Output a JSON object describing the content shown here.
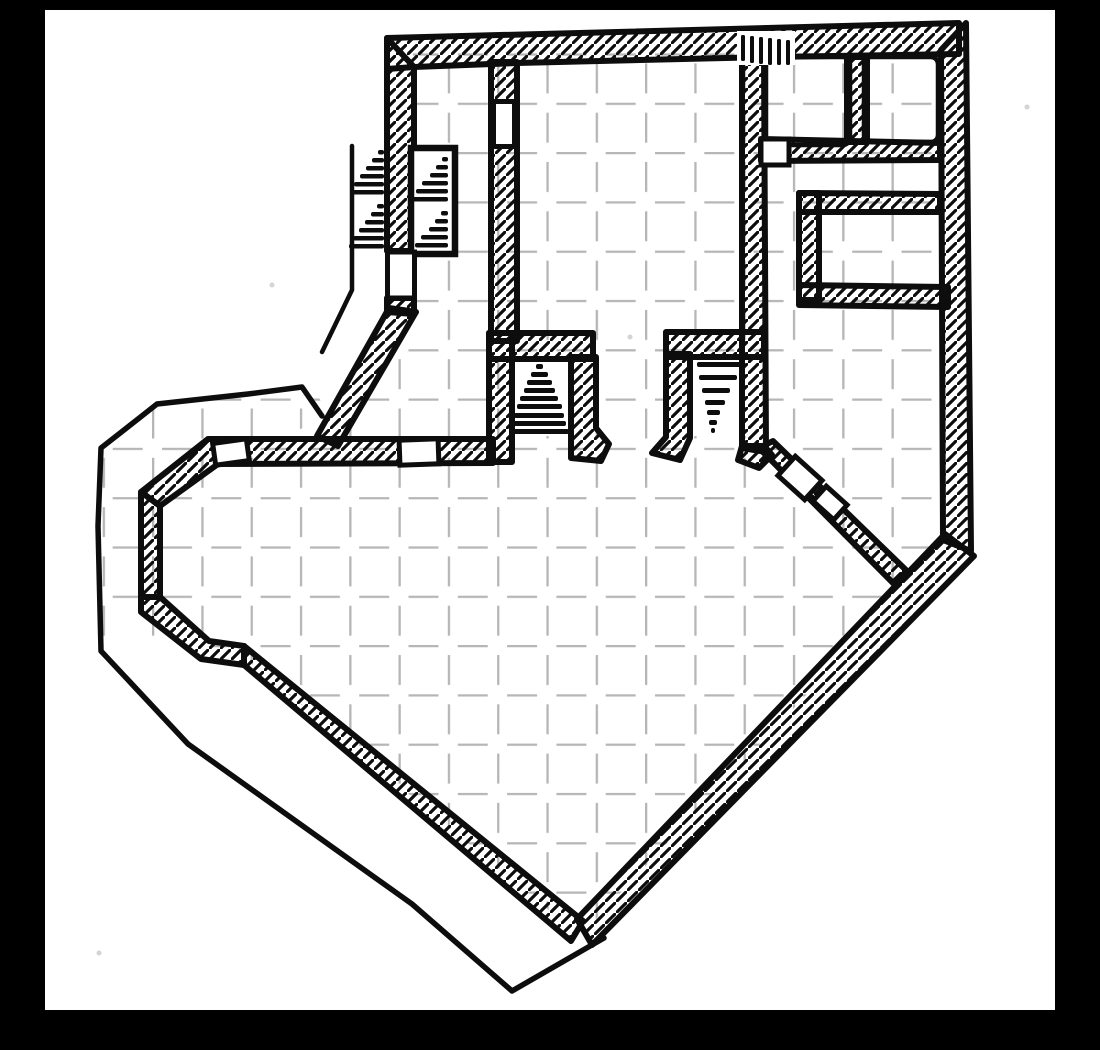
{
  "map": {
    "kind": "hand-drawn dungeon floor plan, ink on graph paper, photographed inside a black frame",
    "style": {
      "frame": "#000000",
      "paper": "#ffffff",
      "ink": "#0d0d0d",
      "grid": "#b6b6b6",
      "speck": "#d4d4d4",
      "wall_stroke": 6,
      "outline_stroke": 5.5,
      "thin_stroke": 4.5,
      "door_stroke": 5,
      "grid_stroke": 4.6,
      "hatch_stroke": 3.2
    },
    "paper_rect": {
      "x": 45,
      "y": 10,
      "w": 1010,
      "h": 1000
    },
    "grid": {
      "origin_x": 53.4,
      "origin_y": 53.4,
      "cell": 49.3,
      "dash_from": 10,
      "dash_to": 40
    },
    "floors": [
      "M493,50 L767,50 L767,352 L493,352 Z",
      "M413,50 L501,50 L501,458 L330,458 L416,310 L413,306 Z",
      "M205,436 L765,436 L765,294 L944,294 L944,548 L580,936 L240,654 L208,648 L136,600 L136,494 Z",
      "M586,338 L667,338 L667,462 L586,462 Z",
      "M759,146 L947,146 L947,204 L807,204 L807,350 L759,350 Z",
      "M761,53 L854,53 L854,150 L761,150 Z",
      "M861,53 L942,53 L942,150 L861,150 Z",
      "M816,206 L950,206 L950,294 L816,294 Z",
      "M158,402 L240,392 L314,386 L328,418 L220,461 L164,505 L164,597 L205,638 L100,638 L100,452 Z"
    ],
    "walls": [
      {
        "name": "wall-north-band",
        "d": "M387,38 L959,23 L959,54 L768,57 L517,63 L414,67 L387,69 Z"
      },
      {
        "name": "wall-west-upper",
        "d": "M387,38 L414,67 L414,251 L387,251 Z"
      },
      {
        "name": "wall-west-stub",
        "d": "M387,298 L414,298 L414,314 L387,312 Z"
      },
      {
        "name": "wall-nw-diagonal",
        "d": "M389,308 L416,312 L338,446 L317,436 Z"
      },
      {
        "name": "wall-hall-west",
        "d": "M491,62 L517,62 L517,341 L491,341 Z"
      },
      {
        "name": "wall-hall-east",
        "d": "M742,55 L764,55 L766,452 L742,448 Z"
      },
      {
        "name": "wall-cavern-north",
        "d": "M208,439 L493,439 L493,463 L218,464 L160,506 L141,492 Z"
      },
      {
        "name": "wall-west-vertical",
        "d": "M141,492 L160,506 L160,597 L141,597 Z"
      },
      {
        "name": "wall-west-bend",
        "d": "M141,597 L160,597 L209,641 L244,646 L244,665 L201,659 L141,612 Z"
      },
      {
        "name": "wall-southwest-diagonal",
        "d": "M244,646 L583,921 L571,941 L244,665 Z"
      },
      {
        "name": "wall-southeast-band",
        "d": "M577,919 L945,534 L974,556 L592,945 Z"
      },
      {
        "name": "wall-east",
        "d": "M941,50 L966,23 L971,551 L943,540 Z"
      },
      {
        "name": "wall-se-inner-diagonal",
        "d": "M759,448 L773,441 L907,571 L895,585 Z"
      },
      {
        "name": "wall-alcove-west-top",
        "d": "M489,333 L593,333 L593,359 L489,359 Z"
      },
      {
        "name": "wall-alcove-west-left",
        "d": "M489,333 L512,333 L512,462 L489,462 Z"
      },
      {
        "name": "wall-alcove-west-right",
        "d": "M571,357 L596,357 L596,428 L609,444 L601,461 L571,458 Z"
      },
      {
        "name": "wall-alcove-east-top",
        "d": "M666,332 L764,332 L764,357 L666,357 Z"
      },
      {
        "name": "wall-alcove-east-left",
        "d": "M666,354 L690,354 L690,438 L680,460 L652,453 L666,437 Z"
      },
      {
        "name": "wall-alcove-east-foot",
        "d": "M742,446 L764,446 L772,455 L759,468 L738,460 Z"
      },
      {
        "name": "wall-ne-rooms-divider",
        "d": "M847,57 L867,57 L867,142 L847,142 Z"
      },
      {
        "name": "wall-ne-rooms-south",
        "d": "M761,139 L940,143 L940,160 L761,161 Z"
      },
      {
        "name": "wall-inner-room-top",
        "d": "M799,193 L940,194 L940,212 L799,212 Z"
      },
      {
        "name": "wall-inner-room-left",
        "d": "M799,193 L819,193 L819,300 L799,300 Z"
      },
      {
        "name": "wall-inner-room-bottom",
        "d": "M799,285 L948,287 L948,307 L799,305 Z"
      }
    ],
    "outlines": [
      {
        "name": "outline-outer-boundary",
        "width": 5.5,
        "d": "M322,416 L302,387 L248,394 L157,404 L138,419 L101,448 L98,526 L101,651 L188,744 L412,904 L512,991 L604,938"
      },
      {
        "name": "outline-west-stair-wall",
        "width": 4.5,
        "d": "M352,146 L352,290 L322,352"
      }
    ],
    "room_borders": [
      {
        "name": "room-ne-1-border",
        "x": 766,
        "y": 57,
        "w": 84,
        "h": 88,
        "r": 7
      },
      {
        "name": "room-ne-2-border",
        "x": 864,
        "y": 57,
        "w": 74,
        "h": 85,
        "r": 7
      }
    ],
    "stair_box": {
      "name": "stair-box",
      "x": 411,
      "y": 148,
      "w": 44,
      "h": 106
    },
    "doors": [
      {
        "name": "door-corridor-to-hall",
        "cx": 504,
        "cy": 124,
        "w": 21,
        "h": 45,
        "angle": 0
      },
      {
        "name": "door-west-wall",
        "cx": 401,
        "cy": 275,
        "w": 27,
        "h": 46,
        "angle": 0
      },
      {
        "name": "door-junction-south-wall",
        "cx": 419,
        "cy": 452,
        "w": 39,
        "h": 25,
        "angle": -2
      },
      {
        "name": "door-corridor-west-end",
        "cx": 231,
        "cy": 452,
        "w": 34,
        "h": 22,
        "angle": -8
      },
      {
        "name": "door-se-diagonal-1",
        "cx": 800,
        "cy": 478,
        "w": 36,
        "h": 26,
        "angle": 42
      },
      {
        "name": "door-se-diagonal-2",
        "cx": 830,
        "cy": 503,
        "w": 28,
        "h": 20,
        "angle": 42
      },
      {
        "name": "door-ne-room1-south",
        "cx": 775,
        "cy": 152,
        "w": 28,
        "h": 26,
        "angle": 0
      }
    ],
    "stairs": [
      {
        "name": "stairs-alcove-west",
        "bar_h": 5,
        "bars": [
          [
            536,
            364,
            7
          ],
          [
            531,
            372,
            17
          ],
          [
            527,
            380,
            25
          ],
          [
            524,
            388,
            31
          ],
          [
            520,
            396,
            38
          ],
          [
            517,
            404,
            45
          ],
          [
            514,
            413,
            50
          ],
          [
            511,
            421,
            55
          ],
          [
            509,
            429,
            60
          ]
        ]
      },
      {
        "name": "stairs-alcove-east",
        "bar_h": 5,
        "bars": [
          [
            697,
            362,
            46
          ],
          [
            699,
            375,
            38
          ],
          [
            702,
            388,
            28
          ],
          [
            705,
            400,
            20
          ],
          [
            707,
            410,
            13
          ],
          [
            709,
            420,
            8
          ],
          [
            711,
            428,
            4
          ]
        ]
      },
      {
        "name": "stairs-west-flight",
        "bar_h": 4.5,
        "bars": [
          [
            378,
            150,
            6
          ],
          [
            372,
            158,
            12
          ],
          [
            366,
            166,
            18
          ],
          [
            360,
            174,
            24
          ],
          [
            354,
            182,
            30
          ],
          [
            350,
            190,
            34
          ],
          [
            377,
            204,
            7
          ],
          [
            371,
            212,
            13
          ],
          [
            365,
            220,
            19
          ],
          [
            359,
            228,
            25
          ],
          [
            353,
            236,
            31
          ],
          [
            349,
            244,
            35
          ]
        ]
      },
      {
        "name": "stairs-boxed-flight",
        "bar_h": 4.5,
        "bars": [
          [
            442,
            157,
            6
          ],
          [
            436,
            165,
            12
          ],
          [
            430,
            173,
            18
          ],
          [
            422,
            181,
            26
          ],
          [
            416,
            189,
            32
          ],
          [
            412,
            197,
            36
          ],
          [
            441,
            211,
            7
          ],
          [
            435,
            219,
            13
          ],
          [
            429,
            227,
            19
          ],
          [
            421,
            235,
            27
          ],
          [
            415,
            243,
            33
          ]
        ]
      }
    ],
    "wall_stairs": {
      "name": "stairs-north-wall",
      "back": [
        737,
        31,
        58,
        34
      ],
      "bars": [
        [
          741,
          35,
          4,
          26
        ],
        [
          750,
          36,
          4,
          27
        ],
        [
          759,
          37,
          4,
          27
        ],
        [
          768,
          38,
          4,
          27
        ],
        [
          777,
          39,
          4,
          26
        ],
        [
          786,
          40,
          4,
          25
        ]
      ]
    },
    "specks": [
      [
        1027,
        107
      ],
      [
        272,
        285
      ],
      [
        99,
        953
      ],
      [
        630,
        337
      ]
    ]
  }
}
